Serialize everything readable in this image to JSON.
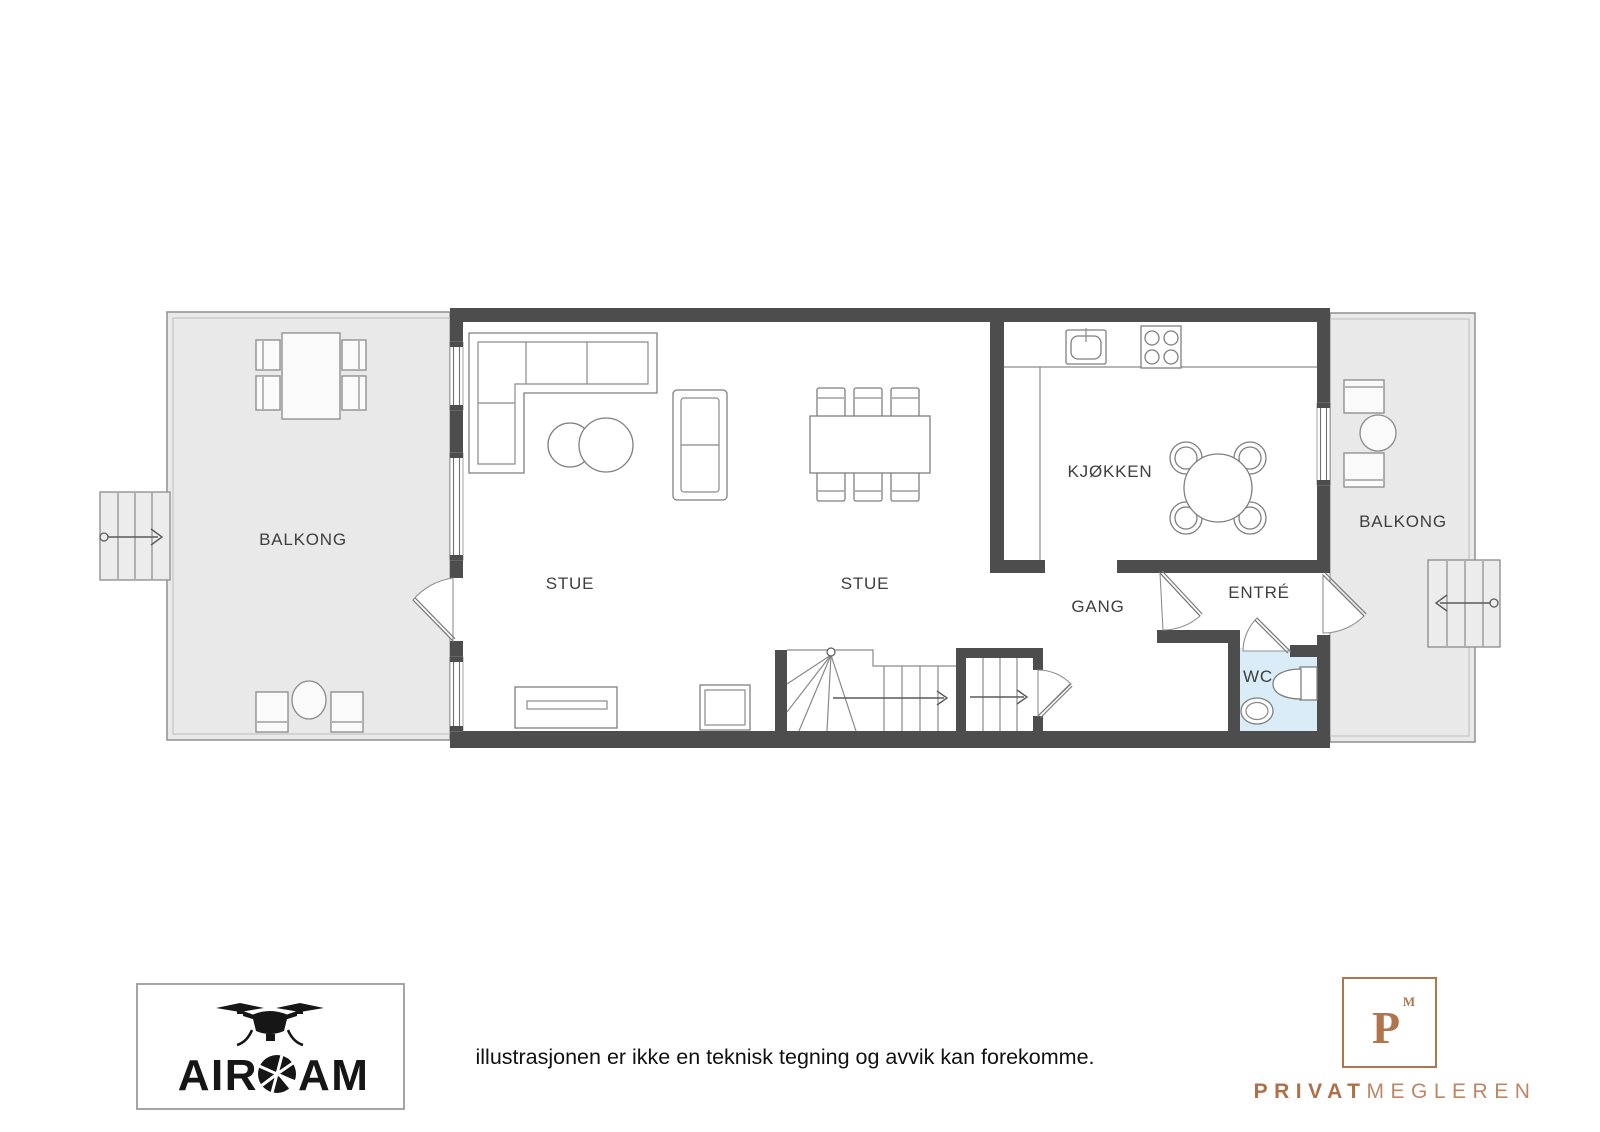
{
  "floorplan": {
    "rooms": [
      {
        "id": "balcony_left",
        "label": "BALKONG"
      },
      {
        "id": "stue_1",
        "label": "STUE"
      },
      {
        "id": "stue_2",
        "label": "STUE"
      },
      {
        "id": "kitchen",
        "label": "KJØKKEN"
      },
      {
        "id": "hall",
        "label": "GANG"
      },
      {
        "id": "entry",
        "label": "ENTRÉ"
      },
      {
        "id": "wc",
        "label": "WC"
      },
      {
        "id": "balcony_right",
        "label": "BALKONG"
      }
    ],
    "colors": {
      "wall": "#4d4d4d",
      "balcony_fill": "#e9e9e9",
      "wc_fill": "#d9ecf7",
      "furniture_line": "#7f7f7f",
      "label_text": "#3e3e3e"
    }
  },
  "footer": {
    "disclaimer": "illustrasjonen er ikke en teknisk tegning og avvik kan forekomme.",
    "aircam": {
      "name": "AIRCAM",
      "text_before_aperture": "AIR",
      "text_after_aperture": "AM",
      "logo_color": "#161616"
    },
    "privatmegleren": {
      "name": "PRIVATMEGLEREN",
      "monogram": "P",
      "monogram_superscript": "M",
      "wordmark_bold": "PRIVAT",
      "wordmark_light": "MEGLEREN",
      "accent": "#b1754e"
    }
  }
}
